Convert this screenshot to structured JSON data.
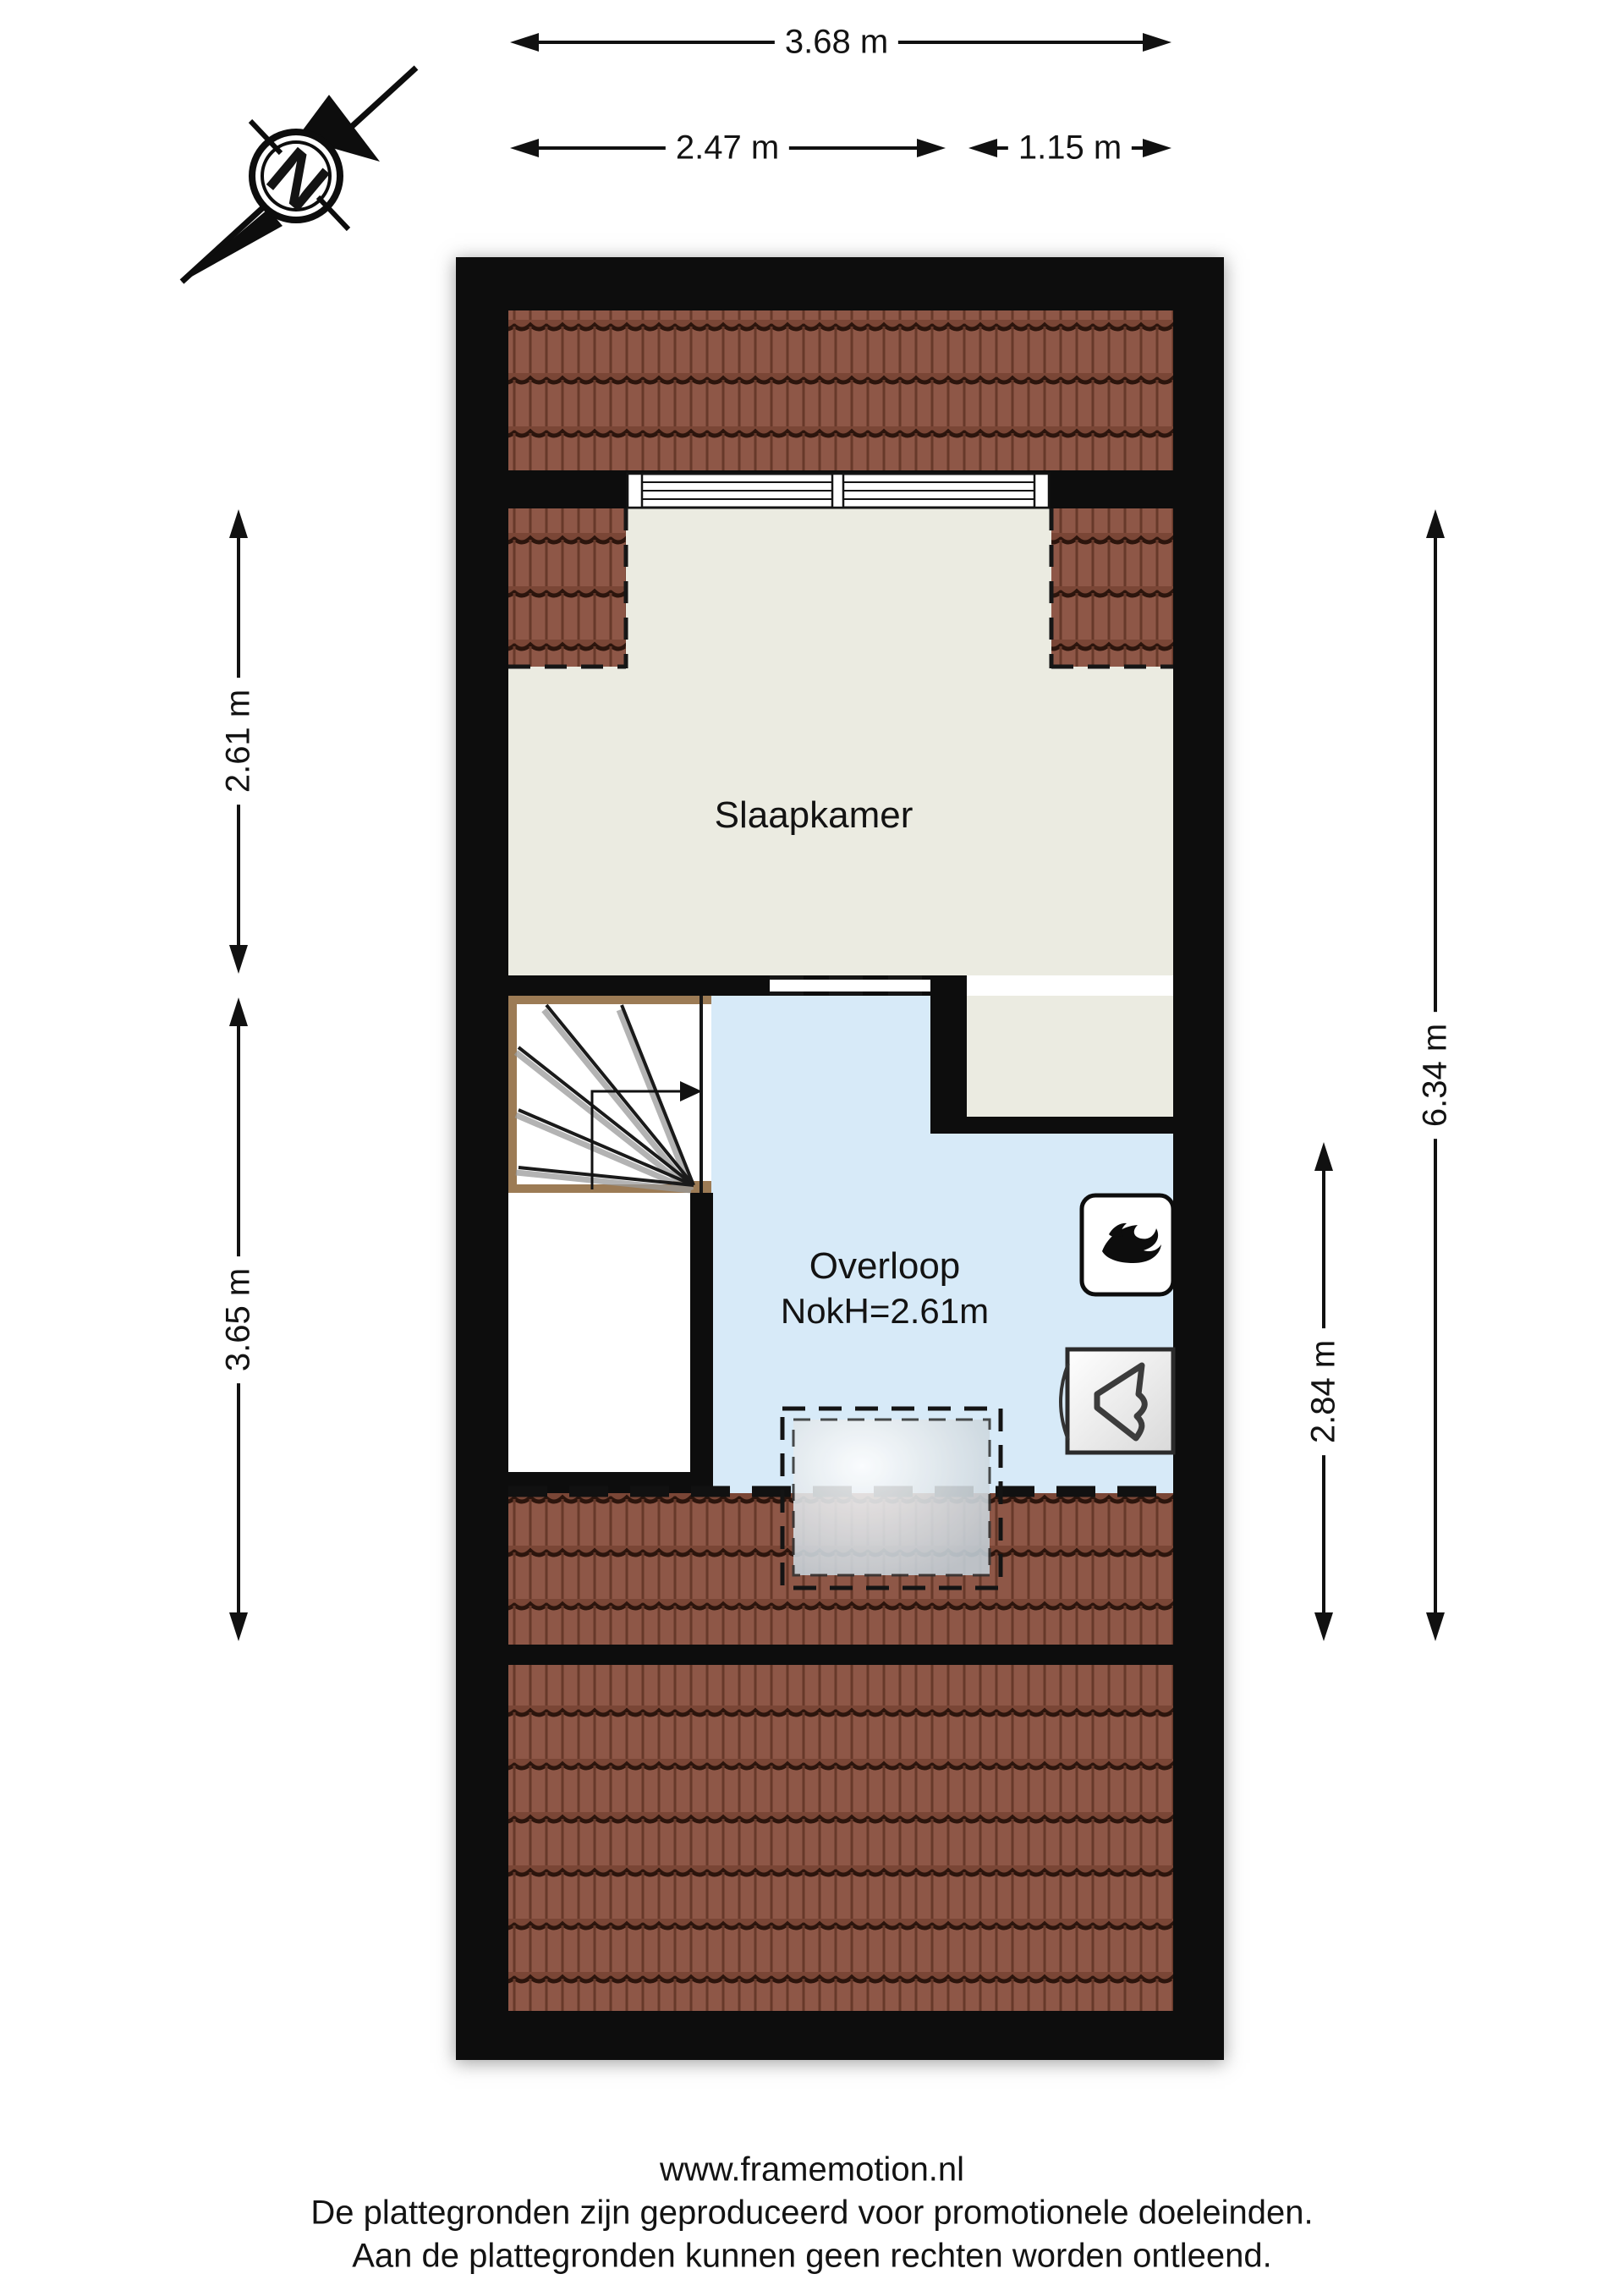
{
  "compass": {
    "label": "N"
  },
  "dimensions": {
    "top_total": "3.68 m",
    "top_left": "2.47 m",
    "top_right": "1.15 m",
    "left_upper": "2.61 m",
    "left_lower": "3.65 m",
    "right_inner": "2.84 m",
    "right_outer": "6.34 m"
  },
  "rooms": {
    "bedroom": {
      "label": "Slaapkamer"
    },
    "landing": {
      "label": "Overloop",
      "ridge_height": "NokH=2.61m"
    }
  },
  "icons": {
    "boiler": "flame-icon",
    "ventilation": "ventilation-unit-icon"
  },
  "footer": {
    "website": "www.framemotion.nl",
    "disclaimer_1": "De plattegronden zijn geproduceerd voor promotionele doeleinden.",
    "disclaimer_2": "Aan de plattegronden kunnen geen rechten worden ontleend."
  },
  "colors": {
    "wall": "#0d0d0d",
    "bedroom_floor": "#ebebe1",
    "landing_floor": "#d7eaf8",
    "roof_tile": "#8e5747",
    "stair_trim": "#9c7b55",
    "dimension": "#111111"
  }
}
